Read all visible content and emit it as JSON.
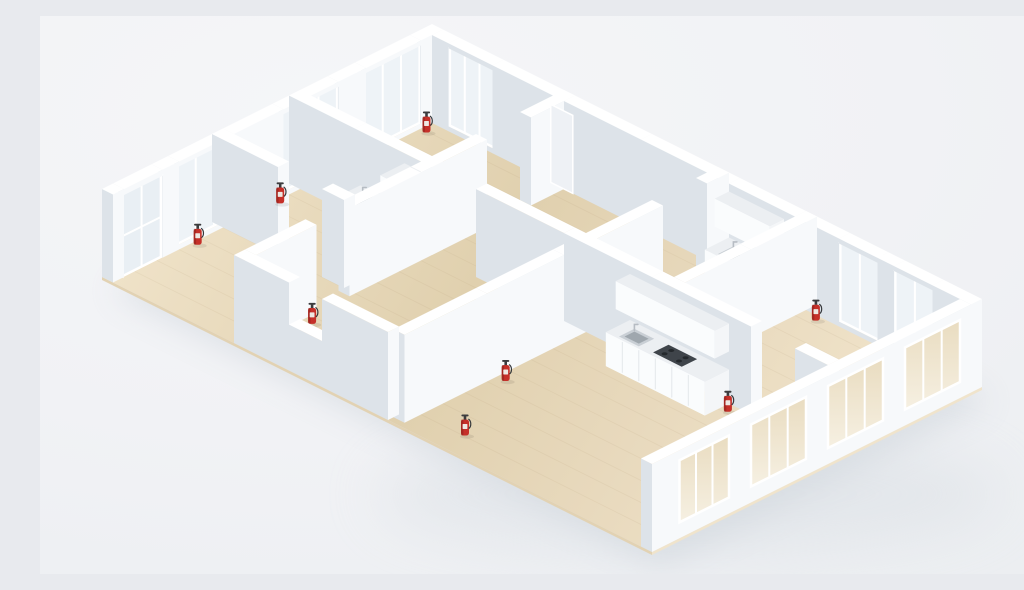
{
  "meta": {
    "title": "3D isometric floor plan render — white dollhouse model with wood floors, windows, kitchenettes and red fire extinguishers",
    "canvas": {
      "w": 1024,
      "h": 558
    }
  },
  "palette": {
    "wall_top": "#ffffff",
    "wall_face_bright": "#f7f9fb",
    "wall_face_shade": "#dde3e9",
    "glass": "#eef3f7",
    "glass_door": "#e9eff4",
    "frame": "#ffffff",
    "recess": "#eef1f5",
    "wood_light": "#efe2c8",
    "wood_mid": "#e0d0ae",
    "wood_warm": "#e8d9bd",
    "slab_side_x": "#f0e4cc",
    "slab_side_y": "#e2d2b3",
    "plank": "#a98f68",
    "counter_top": "#eceff2",
    "counter_front": "#fafcfd",
    "counter_side": "#f4f6f8",
    "seam": "#e3e7eb",
    "sink_outer": "#c9cfd5",
    "sink_inner": "#9fa7ae",
    "faucet": "#b6bcc3",
    "cooktop": "#3f444a",
    "burner": "#24282c",
    "ext_body": "#c53029",
    "ext_dark": "#8f211d",
    "ext_label": "#eee8e2",
    "ext_metal": "#3c3c3e",
    "ext_hose": "#35383b",
    "shadow": "#c4ccd4",
    "shadow_soft": "#d3d9df",
    "se_glass_top": "#e9dcc0",
    "se_glass_bottom": "#f6f0e2"
  },
  "projection": {
    "ox": 392,
    "oy": 96,
    "ux": 11,
    "uy": 5.5,
    "wall_height": 88
  },
  "building": {
    "w": 50,
    "d": 30
  },
  "floor": {
    "slab": {
      "b": [
        0,
        0,
        50,
        30
      ],
      "z": [
        -3,
        0
      ]
    },
    "plank_rows": [
      2,
      4,
      6,
      8,
      10,
      12,
      14,
      16,
      18,
      20,
      22,
      24,
      26,
      28
    ]
  },
  "walls": [
    {
      "b": [
        0,
        0,
        1,
        2
      ],
      "z": [
        0,
        88
      ]
    },
    {
      "b": [
        0,
        7,
        1,
        2.5
      ],
      "z": [
        0,
        88
      ]
    },
    {
      "b": [
        0,
        14.5,
        1,
        4.5
      ],
      "z": [
        0,
        88
      ]
    },
    {
      "b": [
        0,
        24,
        1,
        1.5
      ],
      "z": [
        0,
        88
      ]
    },
    {
      "b": [
        0,
        29,
        1,
        1
      ],
      "z": [
        0,
        88
      ]
    },
    {
      "b": [
        1,
        0,
        1.5,
        1
      ],
      "z": [
        0,
        88
      ]
    },
    {
      "b": [
        6.5,
        0,
        6.5,
        1
      ],
      "z": [
        0,
        88
      ]
    },
    {
      "b": [
        13,
        0,
        7,
        1
      ],
      "z": [
        0,
        88
      ]
    },
    {
      "b": [
        20,
        0,
        8,
        1
      ],
      "z": [
        0,
        88
      ]
    },
    {
      "b": [
        28,
        0,
        6,
        1
      ],
      "z": [
        0,
        88
      ]
    },
    {
      "b": [
        34,
        0,
        4,
        1
      ],
      "z": [
        0,
        88
      ]
    },
    {
      "b": [
        41.5,
        0,
        1.5,
        1
      ],
      "z": [
        0,
        88
      ]
    },
    {
      "b": [
        46.5,
        0,
        3.5,
        1
      ],
      "z": [
        0,
        88
      ]
    },
    {
      "b": [
        49,
        1,
        1,
        29
      ],
      "z": [
        0,
        88
      ]
    },
    {
      "b": [
        12,
        29,
        5,
        1
      ],
      "z": [
        0,
        88
      ]
    },
    {
      "b": [
        20,
        29,
        6,
        1
      ],
      "z": [
        0,
        88
      ]
    },
    {
      "b": [
        17,
        29,
        3,
        1
      ],
      "z": [
        0,
        46
      ]
    },
    {
      "b": [
        0,
        12,
        6,
        1
      ],
      "z": [
        0,
        88
      ]
    },
    {
      "b": [
        6,
        12,
        7,
        1
      ],
      "z": [
        0,
        88
      ]
    },
    {
      "b": [
        17,
        12,
        8,
        1
      ],
      "z": [
        0,
        88
      ]
    },
    {
      "b": [
        25,
        12,
        8,
        1
      ],
      "z": [
        0,
        88
      ]
    },
    {
      "b": [
        33,
        12,
        9,
        1
      ],
      "z": [
        0,
        88
      ]
    },
    {
      "b": [
        46,
        12,
        3,
        1
      ],
      "z": [
        0,
        88
      ]
    },
    {
      "b": [
        0,
        19,
        6,
        1
      ],
      "z": [
        0,
        88
      ]
    },
    {
      "b": [
        10,
        19,
        2,
        1
      ],
      "z": [
        0,
        88
      ]
    },
    {
      "b": [
        12,
        0,
        1,
        4
      ],
      "z": [
        0,
        88
      ]
    },
    {
      "b": [
        12,
        8,
        1,
        6
      ],
      "z": [
        0,
        88
      ]
    },
    {
      "b": [
        12,
        14,
        1,
        6.5
      ],
      "z": [
        0,
        88
      ]
    },
    {
      "b": [
        12,
        23.5,
        1,
        5.5
      ],
      "z": [
        0,
        88
      ]
    },
    {
      "b": [
        26,
        0,
        1,
        2
      ],
      "z": [
        0,
        88
      ]
    },
    {
      "b": [
        26,
        6,
        1,
        9
      ],
      "z": [
        0,
        88
      ]
    },
    {
      "b": [
        26,
        15,
        1,
        7
      ],
      "z": [
        0,
        88
      ]
    },
    {
      "b": [
        26,
        22,
        1,
        7.5
      ],
      "z": [
        0,
        88
      ]
    },
    {
      "b": [
        34,
        0,
        1,
        6
      ],
      "z": [
        0,
        88
      ]
    },
    {
      "b": [
        34,
        6,
        1,
        6
      ],
      "z": [
        0,
        88
      ]
    }
  ],
  "windows_nw": [
    {
      "y0": 2,
      "y1": 7,
      "mullions": 2
    },
    {
      "y0": 9.5,
      "y1": 14.5,
      "mullions": 2
    },
    {
      "y0": 19,
      "y1": 24,
      "mullions": 2
    }
  ],
  "door_nw": {
    "y0": 25.5,
    "y1": 29,
    "z1": 82,
    "rail_z": 40
  },
  "windows_ne": [
    {
      "x0": 2.5,
      "x1": 6.5,
      "mullions": 2
    },
    {
      "x0": 38,
      "x1": 41.5,
      "mullions": 1
    },
    {
      "x0": 43,
      "x1": 46.5,
      "mullions": 1
    }
  ],
  "door_recess_ne": {
    "x0": 11.8,
    "x1": 13.8,
    "z0": 0,
    "z1": 78
  },
  "windows_se": [
    {
      "y0": 2,
      "y1": 7,
      "z0": 16,
      "z1": 78,
      "mullions": 2
    },
    {
      "y0": 9,
      "y1": 14,
      "z0": 16,
      "z1": 78,
      "mullions": 2
    },
    {
      "y0": 16,
      "y1": 21,
      "z0": 16,
      "z1": 78,
      "mullions": 2
    },
    {
      "y0": 23,
      "y1": 27.5,
      "z0": 16,
      "z1": 78,
      "mullions": 2
    }
  ],
  "kitchens": [
    {
      "id": "kitchenette-upper-left",
      "counter": {
        "b": [
          6.5,
          13,
          4,
          2.2
        ],
        "z": [
          0,
          34
        ]
      },
      "tall_cabinet": {
        "b": [
          10.5,
          13,
          1.5,
          2.2
        ],
        "z": [
          0,
          78
        ]
      },
      "sink": {
        "x0": 7.2,
        "y0": 13.5,
        "x1": 8.8,
        "y1": 14.9
      },
      "seams_x": [
        7.8,
        9.2
      ],
      "front_y": 15.2
    },
    {
      "id": "kitchenette-upper-right",
      "counter": {
        "b": [
          28,
          1,
          5,
          2.2
        ],
        "z": [
          0,
          34
        ]
      },
      "upper_cabinet": {
        "b": [
          28,
          1,
          5,
          1.3
        ],
        "z": [
          52,
          80
        ]
      },
      "sink": {
        "x0": 29,
        "y0": 1.6,
        "x1": 30.6,
        "y1": 3.0
      },
      "seams_x": [
        29.25,
        30.5,
        31.75
      ],
      "front_y": 3.2
    },
    {
      "id": "kitchen-lower-right",
      "counter": {
        "b": [
          31,
          13,
          9,
          2.2
        ],
        "z": [
          0,
          34
        ]
      },
      "upper_cabinet": {
        "b": [
          31,
          13,
          9,
          1.3
        ],
        "z": [
          52,
          80
        ]
      },
      "sink": {
        "x0": 32,
        "y0": 13.6,
        "x1": 33.8,
        "y1": 15.0
      },
      "cooktop": {
        "x0": 35,
        "y0": 13.5,
        "x1": 37.6,
        "y1": 14.9
      },
      "seams_x": [
        32.5,
        34,
        35.5,
        37,
        38.5
      ],
      "front_y": 15.2
    }
  ],
  "extinguishers": [
    {
      "x": 1.7,
      "y": 2.2
    },
    {
      "x": 1.5,
      "y": 15.3
    },
    {
      "x": 1.5,
      "y": 22.8
    },
    {
      "x": 13.9,
      "y": 24.8
    },
    {
      "x": 36.5,
      "y": 1.6
    },
    {
      "x": 40.8,
      "y": 13.9
    },
    {
      "x": 27.9,
      "y": 21.2
    },
    {
      "x": 31,
      "y": 28
    }
  ],
  "shadow": {
    "offset": [
      9,
      14
    ],
    "blur": 16,
    "opacity": 0.45,
    "soft_ellipse": {
      "cx": 650,
      "cy": 478,
      "rx": 315,
      "ry": 58,
      "opacity": 0.4,
      "blur": 30
    }
  }
}
